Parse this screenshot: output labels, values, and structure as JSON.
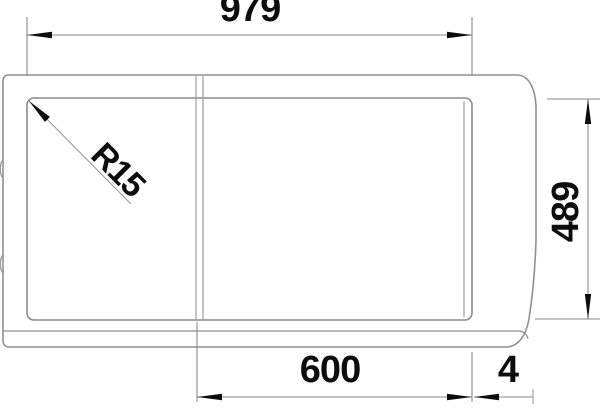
{
  "drawing": {
    "title": "Sink cut-out technical drawing",
    "dimensions": {
      "cutout_width_top": {
        "value": "979"
      },
      "cutout_depth_right": {
        "value": "489"
      },
      "bowl_width_bottom": {
        "value": "600"
      },
      "edge_gap_bottom": {
        "value": "4"
      },
      "corner_radius": {
        "value": "R15"
      }
    },
    "colors": {
      "line_gray": "#919191",
      "text_black": "#0d0d0d",
      "background": "#ffffff"
    }
  }
}
